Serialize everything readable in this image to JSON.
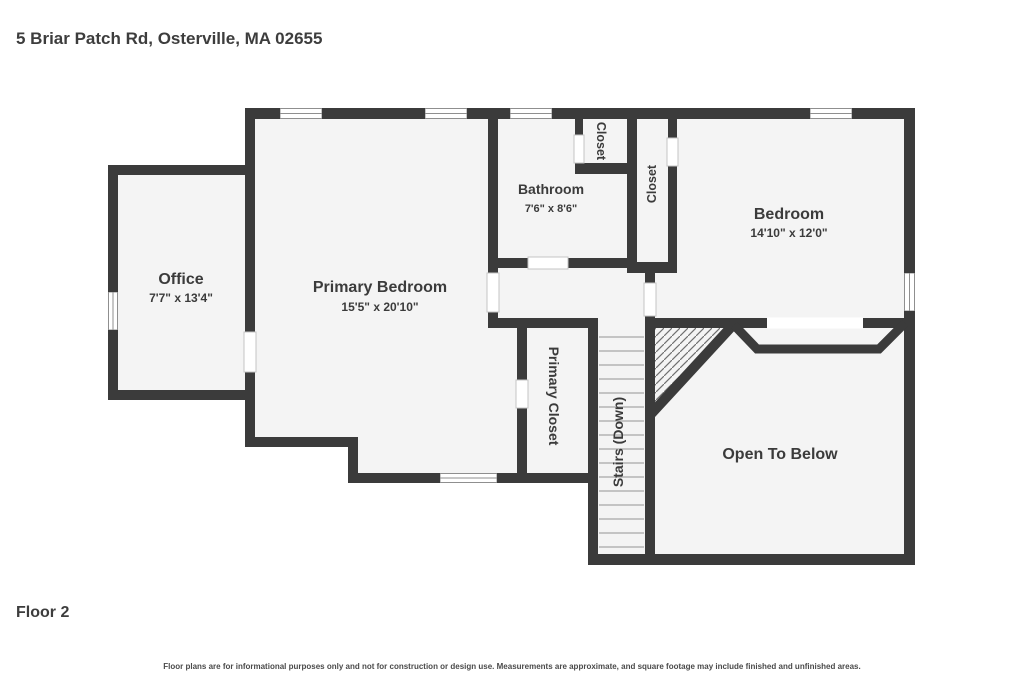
{
  "header": {
    "title": "5 Briar Patch Rd, Osterville, MA 02655"
  },
  "footer": {
    "floor_label": "Floor 2",
    "disclaimer": "Floor plans are for informational purposes only and not for construction or design use. Measurements are approximate, and square footage may include finished and unfinished areas."
  },
  "floor_plan": {
    "colors": {
      "wall": "#3b3b3b",
      "room_fill": "#f4f4f4",
      "background": "#ffffff",
      "label_text": "#3b3b3b"
    },
    "rooms": [
      {
        "id": "office",
        "label": "Office",
        "dimensions": "7'7\" x 13'4\""
      },
      {
        "id": "primary-bedroom",
        "label": "Primary Bedroom",
        "dimensions": "15'5\" x 20'10\""
      },
      {
        "id": "bathroom",
        "label": "Bathroom",
        "dimensions": "7'6\" x 8'6\""
      },
      {
        "id": "closet-bathroom",
        "label": "Closet",
        "dimensions": ""
      },
      {
        "id": "closet-bedroom",
        "label": "Closet",
        "dimensions": ""
      },
      {
        "id": "bedroom",
        "label": "Bedroom",
        "dimensions": "14'10\" x 12'0\""
      },
      {
        "id": "primary-closet",
        "label": "Primary Closet",
        "dimensions": ""
      },
      {
        "id": "stairs",
        "label": "Stairs (Down)",
        "dimensions": ""
      },
      {
        "id": "open-to-below",
        "label": "Open To Below",
        "dimensions": ""
      }
    ]
  }
}
